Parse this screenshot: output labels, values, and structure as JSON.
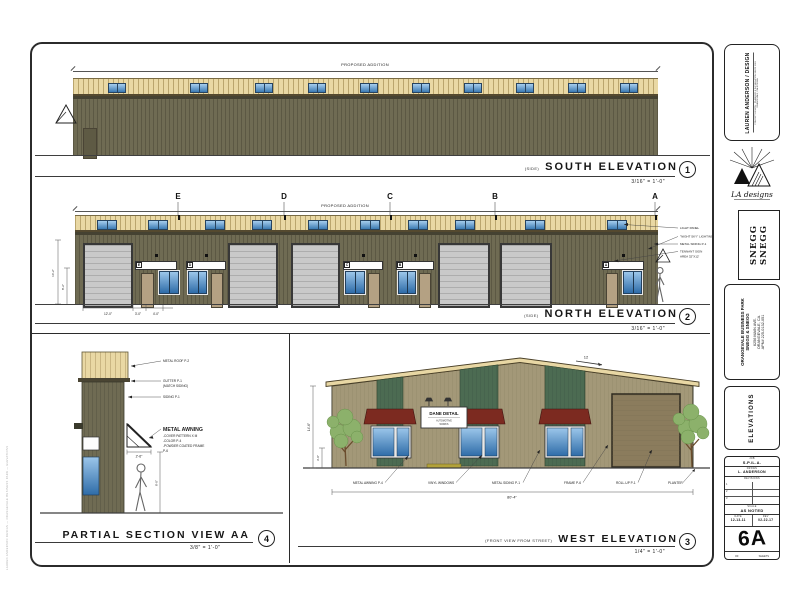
{
  "edge_note": "LAUREN ANDERSON DESIGN — ORANGEVALE BUSINESS PARK — ELEVATIONS",
  "views": {
    "south": {
      "banner": "PROPOSED ADDITION",
      "prefix": "(SIDE)",
      "title": "SOUTH ELEVATION",
      "scale": "3/16\" = 1'-0\"",
      "num": "1"
    },
    "north": {
      "banner": "PROPOSED ADDITION",
      "prefix": "(SIDE)",
      "title": "NORTH ELEVATION",
      "scale": "3/16\" = 1'-0\"",
      "num": "2",
      "grid": [
        "E",
        "D",
        "C",
        "B",
        "A"
      ],
      "callouts": [
        "LIGHT PANEL",
        "\"NIGHT SKY\" LIGHTING",
        "METAL SIDING P-1",
        "TENNANT SIGN",
        "AREA 32\"X12'"
      ],
      "dims_bottom": [
        "12'-0\"",
        "3'-0\"",
        "4'-0\""
      ],
      "dims_left": [
        "14'-2\"",
        "8'-2\""
      ]
    },
    "section": {
      "title": "PARTIAL SECTION VIEW AA",
      "scale": "3/8\" = 1'-0\"",
      "num": "4",
      "callout_roof": "METAL ROOF P-2",
      "callout_gutter": "GUTTER P-1",
      "callout_gutter2": "(MATCH SIDING)",
      "callout_siding": "SIDING P-1",
      "awning_title": "METAL AWNING",
      "awning_lines": [
        "-COVER PATTERN X M",
        "-COLOR P-4",
        "-POWDER COATED FRAME",
        "P-6"
      ],
      "dim_awning": "2'-6\"",
      "dim_height": "8'-0\""
    },
    "west": {
      "prefix": "(FRONT VIEW FROM STREET)",
      "title": "WEST ELEVATION",
      "scale": "1/4\" = 1'-0\"",
      "num": "3",
      "slope": "12",
      "sign1": "DANE DETAIL",
      "sign2": "AUTOMOTIVE",
      "sign3": "WORKS",
      "callouts": [
        "METAL AWNING P-4",
        "VINYL WINDOWS",
        "METAL SIDING P-1",
        "FRAME P-6",
        "ROLL-UP P-1",
        "PLANTER"
      ],
      "dim_bottom": "80'-4\"",
      "dim_left": "14'-6\"",
      "dim_left2": "3'-0\""
    }
  },
  "titleblock": {
    "firm_name": "LAUREN ANDERSON / DESIGN",
    "firm_line1": "CONCEPT DESIGN - PLANNING & INSTALLATION SINCE 1991",
    "firm_line2": "ORANGEVALE, CALIFORNIA",
    "logo_text": "LA designs",
    "stamp1": "SNEGG",
    "stamp2": "SNEGG",
    "project_name": "ORANGEVALE BUSINESS PARK",
    "project_client": "SNEGG & SNEGG",
    "addr1": "6256 MAIN AVE.",
    "addr2": "ORANGEVALE, CA.",
    "apn": "APN# 225-0132-051",
    "sheet_title": "ELEVATIONS",
    "job_label": "JOB",
    "job": "S.P./L.A.",
    "drawn_label": "DRAWN",
    "drawn": "L. ANDERSON",
    "revisions_label": "REVISIONS",
    "rev_rows": [
      "1",
      "2",
      "3"
    ],
    "scale_label": "SCALE",
    "scale": "AS NOTED",
    "date_label": "DATE",
    "date": "12-13-11",
    "rev_label": "REV",
    "rev_date": "02-22-17",
    "sheet_num": "6A",
    "of_label": "OF",
    "sheets_label": "SHEETS"
  }
}
